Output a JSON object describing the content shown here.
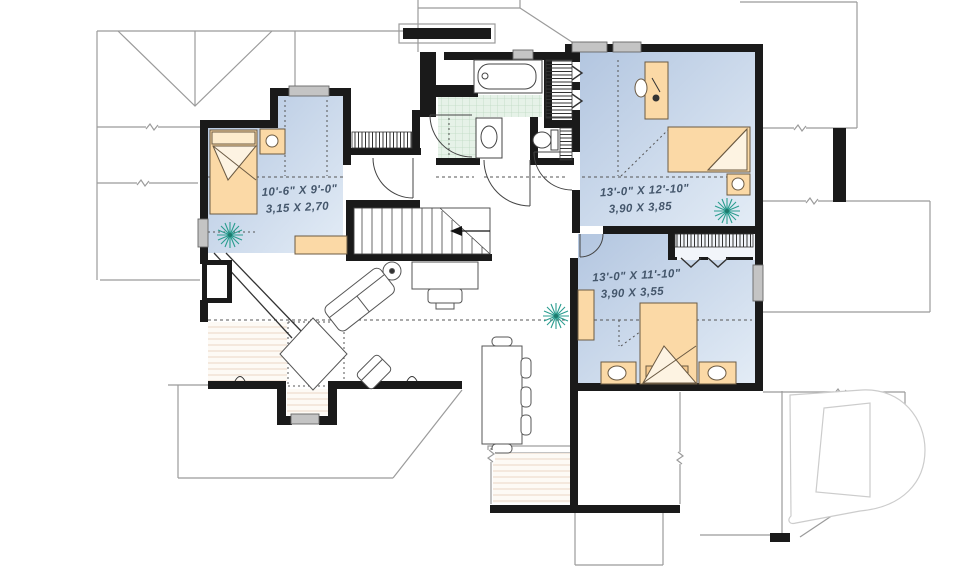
{
  "plan": {
    "type": "second-floor-plan",
    "rooms": [
      {
        "id": "bedroom-left",
        "imperial": "10'-6\" X 9'-0\"",
        "metric": "3,15 X 2,70"
      },
      {
        "id": "bedroom-top-right",
        "imperial": "13'-0\" X 12'-10\"",
        "metric": "3,90 X 3,85"
      },
      {
        "id": "bedroom-bottom-right",
        "imperial": "13'-0\" X 11'-10\"",
        "metric": "3,90 X 3,55"
      }
    ],
    "logo": {
      "letter": "D"
    },
    "colors": {
      "wall": "#1a1a1a",
      "roofline": "#9b9b9b",
      "room_fill_dark": "#b5c7e1",
      "room_fill_light": "#e3ecf6",
      "furniture": "#fbd9a6",
      "plant": "#2a9d8f",
      "label_text": "#44566b",
      "window": "#c4c4c4",
      "tile": "#e6f2e8",
      "wood_line": "#ead7c5",
      "logo_outline": "#cccccc"
    }
  }
}
